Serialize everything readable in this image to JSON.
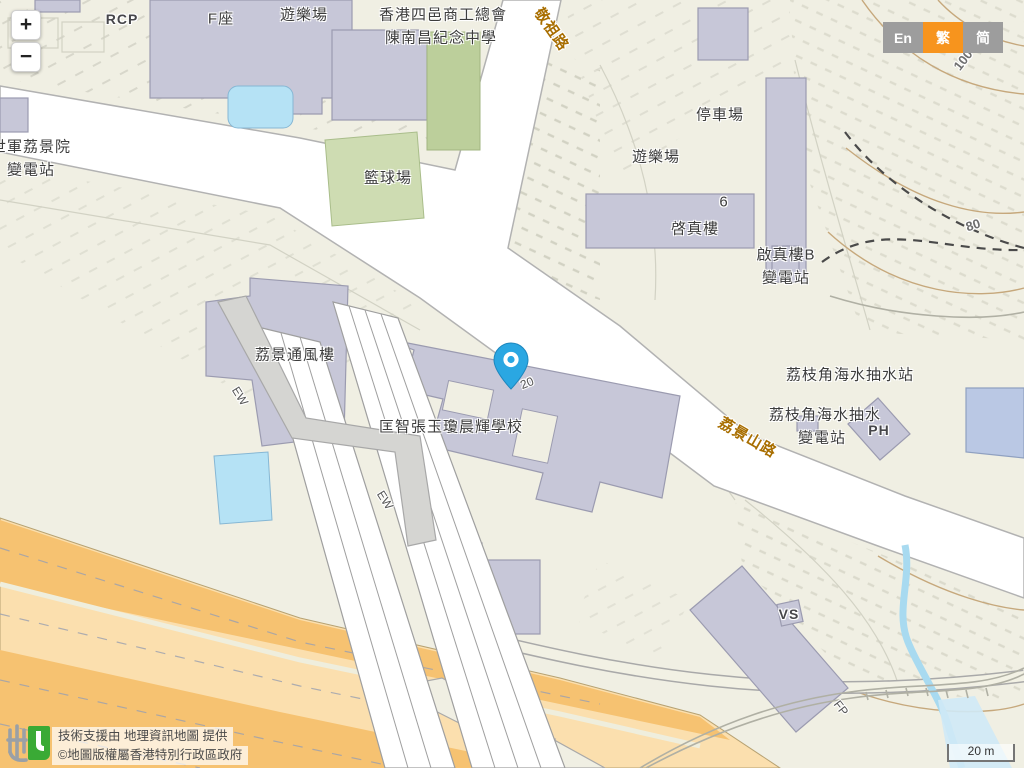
{
  "app": {
    "name": "GeoInfo Map"
  },
  "controls": {
    "zoom_in_label": "+",
    "zoom_out_label": "−",
    "languages": [
      {
        "label": "En",
        "active": false
      },
      {
        "label": "繁",
        "active": true
      },
      {
        "label": "简",
        "active": false
      }
    ]
  },
  "attribution": {
    "logo": "geoinfo-map-logo",
    "line1": "技術支援由 地理資訊地圖 提供",
    "line2": "©地圖版權屬香港特別行政區政府"
  },
  "scale_bar": {
    "label": "20 m"
  },
  "marker": {
    "name": "blue-location-pin",
    "color": "#2aa7e2",
    "tip_x": 511,
    "tip_y": 388
  },
  "colors": {
    "background": "#f0efe3",
    "building": "#c7c7d8",
    "building_outline": "#9b9bb0",
    "road_fill": "#ffffff",
    "road_casing": "#b2b2b2",
    "highway_orange_dark": "#f6c271",
    "highway_orange_light": "#fbdfae",
    "water": "#b5e2f5",
    "court_green_dark": "#bccf9b",
    "court_green_light": "#cedcb2",
    "walkway_gray": "#d5d5d2",
    "contour": "#c6a87c",
    "lang_active": "#f7941d",
    "lang_inactive": "#9d9d9d",
    "road_label": "#a86e00"
  },
  "map": {
    "labels": [
      {
        "id": "rcp",
        "text": "RCP",
        "x": 122,
        "y": 19,
        "rot": 0,
        "type": "place-en"
      },
      {
        "id": "block-f",
        "text": "F座",
        "x": 221,
        "y": 18,
        "rot": 0,
        "type": "place"
      },
      {
        "id": "playground-top",
        "text": "遊樂場",
        "x": 304,
        "y": 14,
        "rot": 0,
        "type": "place"
      },
      {
        "id": "school-line1",
        "text": "香港四邑商工總會",
        "x": 443,
        "y": 14,
        "rot": 0,
        "type": "place"
      },
      {
        "id": "school-line2",
        "text": "陳南昌紀念中學",
        "x": 441,
        "y": 37,
        "rot": 0,
        "type": "place"
      },
      {
        "id": "king-cho-road",
        "text": "敬祖路",
        "x": 552,
        "y": 29,
        "rot": 55,
        "type": "road"
      },
      {
        "id": "salvation-army",
        "text": "世軍荔景院",
        "x": 31,
        "y": 146,
        "rot": 0,
        "type": "place"
      },
      {
        "id": "substation-left",
        "text": "變電站",
        "x": 31,
        "y": 169,
        "rot": 0,
        "type": "place"
      },
      {
        "id": "car-park",
        "text": "停車場",
        "x": 720,
        "y": 114,
        "rot": 0,
        "type": "place"
      },
      {
        "id": "playground-mid",
        "text": "遊樂場",
        "x": 656,
        "y": 156,
        "rot": 0,
        "type": "place"
      },
      {
        "id": "basketball-court",
        "text": "籃球場",
        "x": 388,
        "y": 177,
        "rot": 0,
        "type": "place"
      },
      {
        "id": "house-no-6",
        "text": "6",
        "x": 724,
        "y": 202,
        "rot": 0,
        "type": "place"
      },
      {
        "id": "kai-chun-house",
        "text": "啓真樓",
        "x": 695,
        "y": 228,
        "rot": 0,
        "type": "place"
      },
      {
        "id": "kai-chun-b",
        "text": "啟真樓B",
        "x": 786,
        "y": 254,
        "rot": 0,
        "type": "place"
      },
      {
        "id": "substation-kai-chun",
        "text": "變電站",
        "x": 786,
        "y": 277,
        "rot": 0,
        "type": "place"
      },
      {
        "id": "contour-100",
        "text": "100",
        "x": 963,
        "y": 60,
        "rot": -52,
        "type": "contour"
      },
      {
        "id": "contour-80",
        "text": "80",
        "x": 973,
        "y": 225,
        "rot": -18,
        "type": "contour"
      },
      {
        "id": "ventilation-bldg",
        "text": "荔景通風樓",
        "x": 295,
        "y": 354,
        "rot": 0,
        "type": "place"
      },
      {
        "id": "ew-1",
        "text": "EW",
        "x": 240,
        "y": 396,
        "rot": 58,
        "type": "small"
      },
      {
        "id": "hong-chi-school",
        "text": "匡智張玉瓊晨輝學校",
        "x": 451,
        "y": 426,
        "rot": 0,
        "type": "place"
      },
      {
        "id": "lot-20",
        "text": "20",
        "x": 527,
        "y": 383,
        "rot": -22,
        "type": "small"
      },
      {
        "id": "pumping-station",
        "text": "荔枝角海水抽水站",
        "x": 850,
        "y": 374,
        "rot": 0,
        "type": "place"
      },
      {
        "id": "pumping-sub-1",
        "text": "荔枝角海水抽水",
        "x": 825,
        "y": 414,
        "rot": 0,
        "type": "place"
      },
      {
        "id": "pumping-sub-2",
        "text": "變電站",
        "x": 822,
        "y": 437,
        "rot": 0,
        "type": "place"
      },
      {
        "id": "ph",
        "text": "PH",
        "x": 879,
        "y": 430,
        "rot": 0,
        "type": "place-en"
      },
      {
        "id": "lai-king-hill-road",
        "text": "荔景山路",
        "x": 748,
        "y": 437,
        "rot": 30,
        "type": "road"
      },
      {
        "id": "vs",
        "text": "VS",
        "x": 789,
        "y": 614,
        "rot": 0,
        "type": "place-en"
      },
      {
        "id": "ew-2",
        "text": "EW",
        "x": 385,
        "y": 500,
        "rot": 58,
        "type": "small"
      },
      {
        "id": "fp",
        "text": "FP",
        "x": 841,
        "y": 708,
        "rot": 52,
        "type": "small"
      }
    ]
  }
}
